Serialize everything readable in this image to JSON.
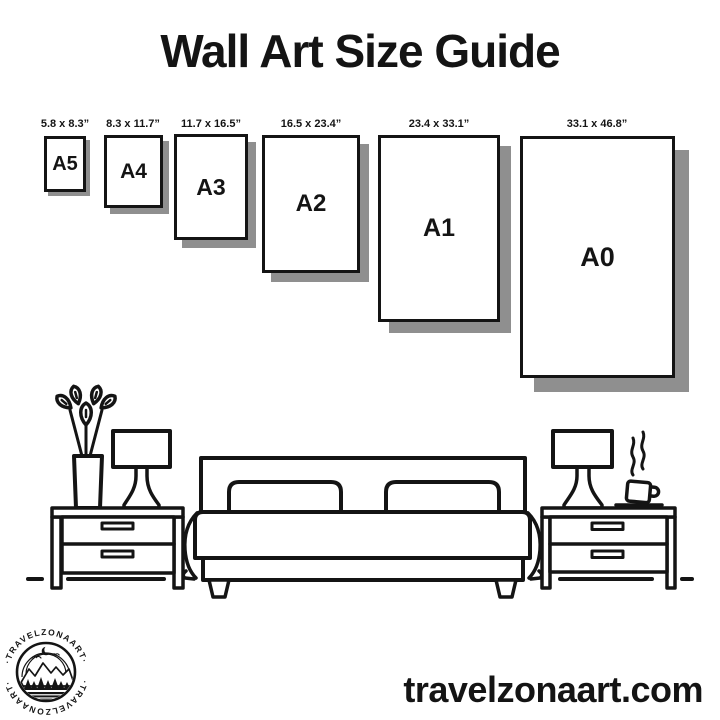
{
  "title": "Wall Art Size Guide",
  "frames": [
    {
      "code": "A5",
      "size": "5.8 x 8.3”"
    },
    {
      "code": "A4",
      "size": "8.3 x 11.7”"
    },
    {
      "code": "A3",
      "size": "11.7 x 16.5”"
    },
    {
      "code": "A2",
      "size": "16.5 x 23.4”"
    },
    {
      "code": "A1",
      "size": "23.4 x 33.1”"
    },
    {
      "code": "A0",
      "size": "33.1 x 46.8”"
    }
  ],
  "logo": {
    "brand_top": "·TRAVELZONAART·",
    "brand_bottom": "·TRAVELZONAART·"
  },
  "website": "travelzonaart.com",
  "colors": {
    "ink": "#141414",
    "shadow": "#8f8f8f",
    "background": "#ffffff"
  },
  "illustration": {
    "items": [
      "plant-vase",
      "table-lamp-left",
      "nightstand-left",
      "bed-with-pillows",
      "table-lamp-right",
      "coffee-cup",
      "nightstand-right",
      "floor-line"
    ]
  }
}
